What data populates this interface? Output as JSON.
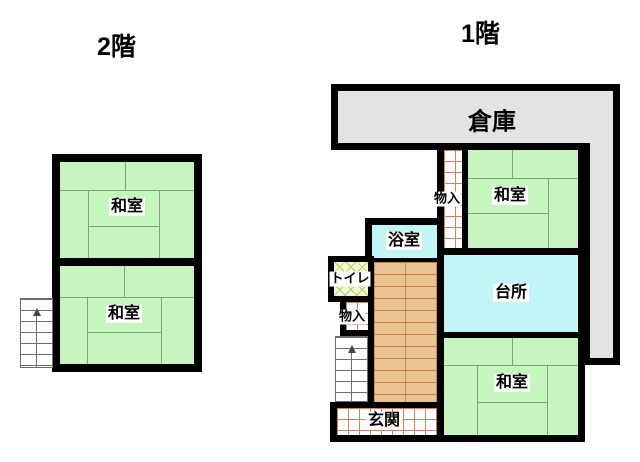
{
  "floors": {
    "second": {
      "title": "2階",
      "rooms": {
        "washitsu_upper": "和室",
        "washitsu_lower": "和室"
      }
    },
    "first": {
      "title": "1階",
      "rooms": {
        "souko": "倉庫",
        "monoiri_upper": "物入",
        "washitsu_upper": "和室",
        "yokushitsu": "浴室",
        "toire": "トイレ",
        "monoiri_lower": "物入",
        "daidokoro": "台所",
        "washitsu_lower": "和室",
        "genkan": "玄関"
      }
    }
  },
  "colors": {
    "tatami_room_green": "#c6f6bd",
    "water_room_cyan": "#c3f4f6",
    "storage_gray": "#e3e3e3",
    "wood_floor_tan": "#ebc493",
    "tile_grid_red": "#d08060",
    "lattice_green": "#a9d36e",
    "wall_black": "#000000"
  }
}
